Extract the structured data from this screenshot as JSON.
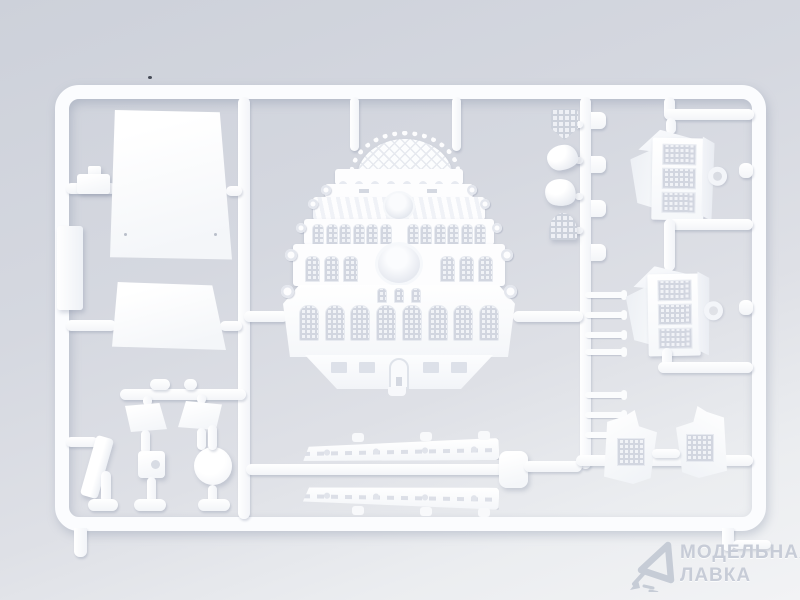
{
  "scene": {
    "description": "Photograph of a white injection-moulded plastic model-kit sprue holding parts of an ornate sailing-ship stern (stern transom plate, quarter galleries, deck panels, hull strips and small fittings) on a pale blue-grey backdrop",
    "colors": {
      "background_top": "#cdd1da",
      "background_bottom": "#f2f3f5",
      "plastic": "#fbfcfe",
      "moulding_shadow": "#d3d7e0",
      "watermark": "#c7ccd7"
    },
    "parts": [
      "large-deck-panel",
      "small-deck-panel",
      "stern-transom-plate",
      "quarter-gallery-upper",
      "quarter-gallery-lower",
      "gallery-roof-piece-left",
      "gallery-roof-piece-right",
      "hull-side-strip-upper",
      "hull-side-strip-lower",
      "shield-ornament",
      "shell-ornament-1",
      "shell-ornament-2",
      "dome-ornament",
      "railing-rungs",
      "rudder-blade",
      "round-disc",
      "square-fitting",
      "flag-trapezoid-left",
      "flag-trapezoid-right",
      "side-plank",
      "clip-fitting"
    ]
  },
  "watermark": {
    "line1": "МОДЕЛЬНАЯ",
    "line2": "ЛАВКА",
    "logo": "triangle-pick-logo"
  }
}
